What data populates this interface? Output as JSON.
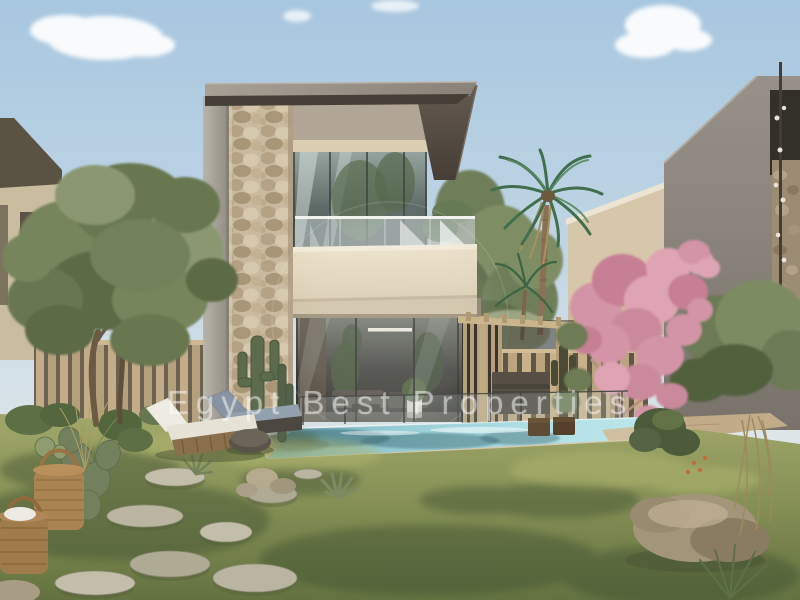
{
  "image": {
    "type": "3d-architectural-render",
    "subject": "Modern two-storey villa with stone-clad pillar, glass facade, balcony, pergola, swimming pool and landscaped desert garden",
    "watermark": {
      "text": "Egypt Best Properties",
      "style": "semi-transparent white, letter-spaced, centered",
      "logo": "faint translucent circle over facade"
    }
  },
  "palette": {
    "sky_top": "#a7c6df",
    "sky_horizon": "#e9ebe5",
    "cloud": "#ffffff",
    "roof_slab": "#9c948a",
    "dark_fascia": "#554c42",
    "concrete_column": "#a8a29a",
    "stone_pillar": "#c9b99e",
    "cream_wall": "#e2d5bd",
    "glass_facade": "#667370",
    "wood_fence": "#c9b28c",
    "grass": "#8a9459",
    "pool_water": "#9ed2da",
    "pink_tree": "#d294a6",
    "olive_foliage": "#6b7a55",
    "neighbor_house_gray": "#8a847c",
    "neighbor_house_beige": "#d7c7aa"
  }
}
